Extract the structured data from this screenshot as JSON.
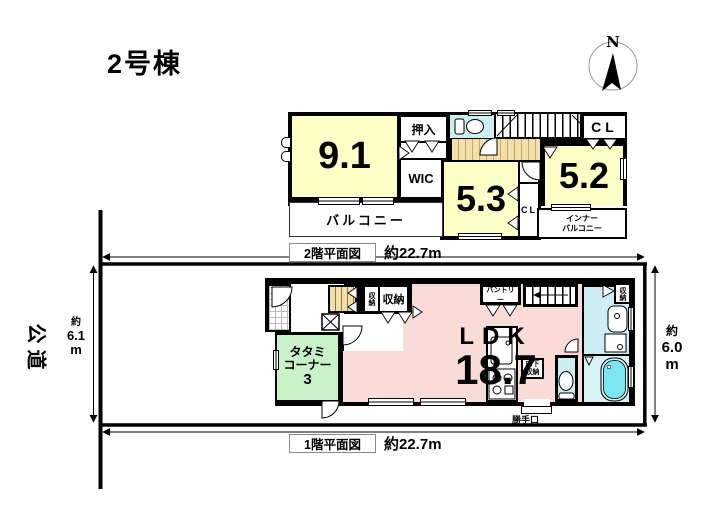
{
  "title": "2号棟",
  "compass": {
    "north": "N"
  },
  "floor2": {
    "plan_label": "2階平面図",
    "width_dim": "約22.7m",
    "room_9_1": "9.1",
    "closet_oshiire": "押入",
    "wic": "WIC",
    "closet_cl_top": "CL",
    "room_5_3": "5.3",
    "closet_cl_mid": "CL",
    "room_5_2": "5.2",
    "balcony": "バルコニー",
    "inner_balcony_l1": "インナー",
    "inner_balcony_l2": "バルコニー"
  },
  "floor1": {
    "plan_label": "1階平面図",
    "width_dim": "約22.7m",
    "ldk": "LDK",
    "ldk_size": "18.7",
    "tatami_l1": "タタミ",
    "tatami_l2": "コーナー",
    "tatami_l3": "3",
    "storage_hall_small": "収納",
    "storage_hall": "収納",
    "pantry": "パントリー",
    "storage_washroom": "収納",
    "underfloor_l1": "床下",
    "underfloor_l2": "収納",
    "back_door": "勝手口"
  },
  "site": {
    "road": "公道",
    "left_depth_l1": "約",
    "left_depth_l2": "6.1",
    "left_depth_l3": "m",
    "right_depth_l1": "約",
    "right_depth_l2": "6.0",
    "right_depth_l3": "m"
  },
  "colors": {
    "wall": "#000000",
    "room_yellow": "#ffffc8",
    "ldk_pink": "#f9dcd8",
    "tatami_green": "#c9f2c9",
    "water_blue": "#cdeef5",
    "bathtub_cyan": "#7ce6f0",
    "wood_tan": "#f2e0ac"
  }
}
